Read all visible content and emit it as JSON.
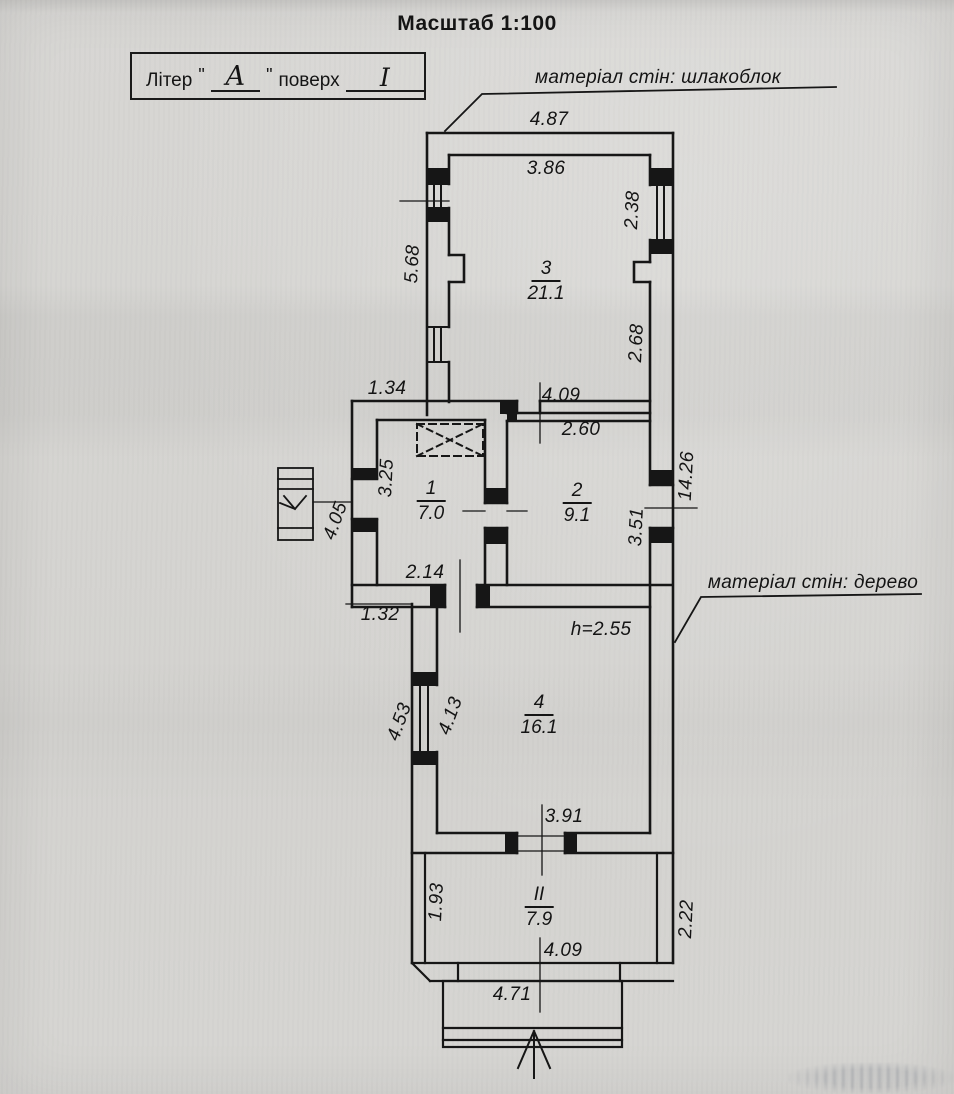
{
  "page": {
    "scale_title": "Масштаб 1:100"
  },
  "title_box": {
    "label": "Літер",
    "open_quote": "\"",
    "letter": "А",
    "close_quote": "\"",
    "floor_label": "поверх",
    "floor_value": "I"
  },
  "notes": {
    "wall_material_top": "матеріал стін: шлакоблок",
    "wall_material_right": "матеріал стін: дерево",
    "ceiling_height": "h=2.55"
  },
  "rooms": [
    {
      "number": "3",
      "area": "21.1"
    },
    {
      "number": "1",
      "area": "7.0"
    },
    {
      "number": "2",
      "area": "9.1"
    },
    {
      "number": "4",
      "area": "16.1"
    },
    {
      "number": "II",
      "area": "7.9"
    }
  ],
  "dimensions": {
    "top_outer_width": "4.87",
    "top_inner_width": "3.86",
    "right_window": "2.38",
    "left_wall_top": "5.68",
    "right_inner_top": "2.68",
    "mid_left_offset": "1.34",
    "mid_opening": "4.09",
    "room2_width": "2.60",
    "room1_height": "3.25",
    "stairs_width": "4.05",
    "room2_height": "3.51",
    "overall_right": "14.26",
    "room1_width": "2.14",
    "lower_left_offset": "1.32",
    "room4_wall_outer": "4.53",
    "room4_wall_inner": "4.13",
    "room4_opening": "3.91",
    "veranda_left": "1.93",
    "veranda_right": "2.22",
    "veranda_width": "4.09",
    "bottom_outer_width": "4.71"
  }
}
